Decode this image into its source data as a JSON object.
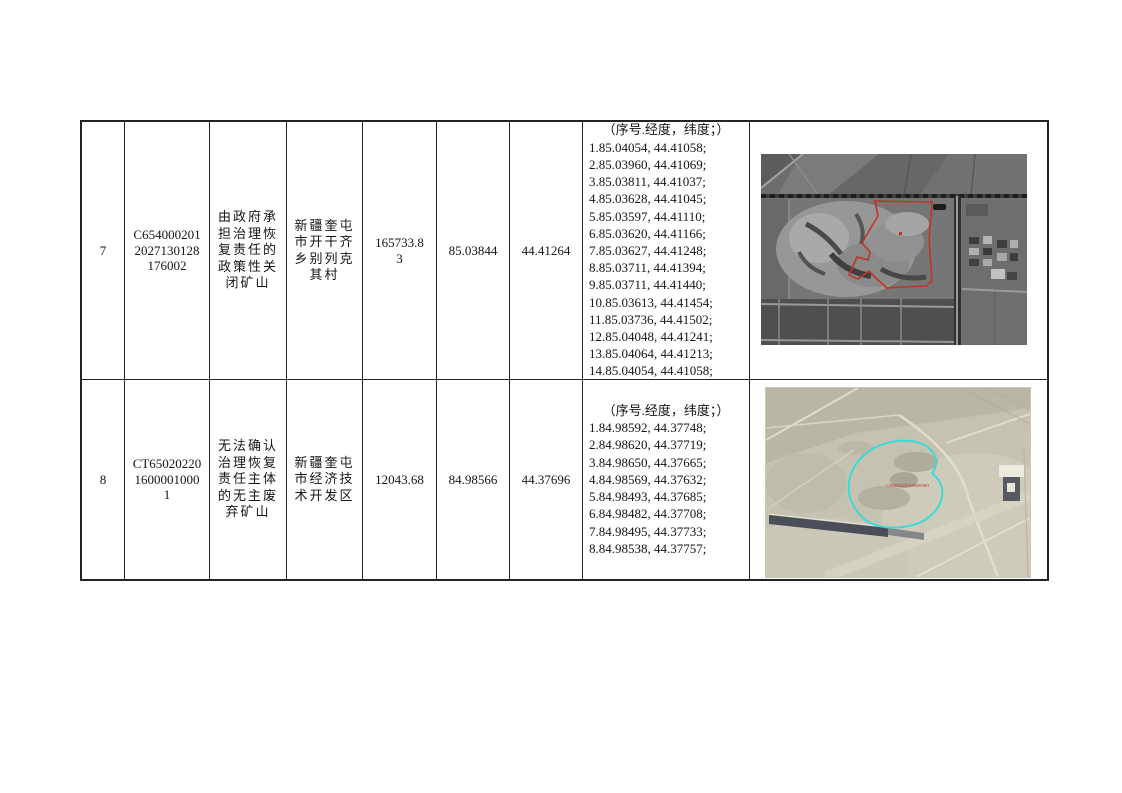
{
  "table": {
    "border_color": "#232323",
    "coords_header_label": "（序号.经度，纬度；）",
    "rows": [
      {
        "index": "7",
        "plot_id_lines": [
          "C654000201",
          "2027130128",
          "176002"
        ],
        "type_lines": [
          "由政府承",
          "担治理恢",
          "复责任的",
          "政策性关",
          "闭矿山"
        ],
        "location_lines": [
          "新疆奎屯",
          "市开干齐",
          "乡别列克",
          "其村"
        ],
        "area_lines": [
          "165733.8",
          "3"
        ],
        "longitude": "85.03844",
        "latitude": "44.41264",
        "coords_header": "（序号.经度，纬度；）",
        "coords": [
          "1.85.04054, 44.41058;",
          "2.85.03960, 44.41069;",
          "3.85.03811, 44.41037;",
          "4.85.03628, 44.41045;",
          "5.85.03597, 44.41110;",
          "6.85.03620, 44.41166;",
          "7.85.03627, 44.41248;",
          "8.85.03711, 44.41394;",
          "9.85.03711, 44.41440;",
          "10.85.03613, 44.41454;",
          "11.85.03736, 44.41502;",
          "12.85.04048, 44.41241;",
          "13.85.04064, 44.41213;",
          "14.85.04054, 44.41058;"
        ],
        "image": {
          "kind": "grayscale satellite photo of farmland with mine pit",
          "boundary_color": "#c23428"
        }
      },
      {
        "index": "8",
        "plot_id_lines": [
          "CT65020220",
          "1600001000",
          "1"
        ],
        "type_lines": [
          "无法确认",
          "治理恢复",
          "责任主体",
          "的无主废",
          "弃矿山"
        ],
        "location_lines": [
          "新疆奎屯",
          "市经济技",
          "术开发区"
        ],
        "area_lines": [
          "12043.68"
        ],
        "longitude": "84.98566",
        "latitude": "44.37696",
        "coords_header": "（序号.经度，纬度；）",
        "coords": [
          "1.84.98592, 44.37748;",
          "2.84.98620, 44.37719;",
          "3.84.98650, 44.37665;",
          "4.84.98569, 44.37632;",
          "5.84.98493, 44.37685;",
          "6.84.98482, 44.37708;",
          "7.84.98495, 44.37733;",
          "8.84.98538, 44.37757;"
        ],
        "image": {
          "kind": "color satellite photo of desert site",
          "boundary_color": "#3cd9d9",
          "label": "CT650202201600001001",
          "label_color": "#c03028"
        }
      }
    ]
  }
}
